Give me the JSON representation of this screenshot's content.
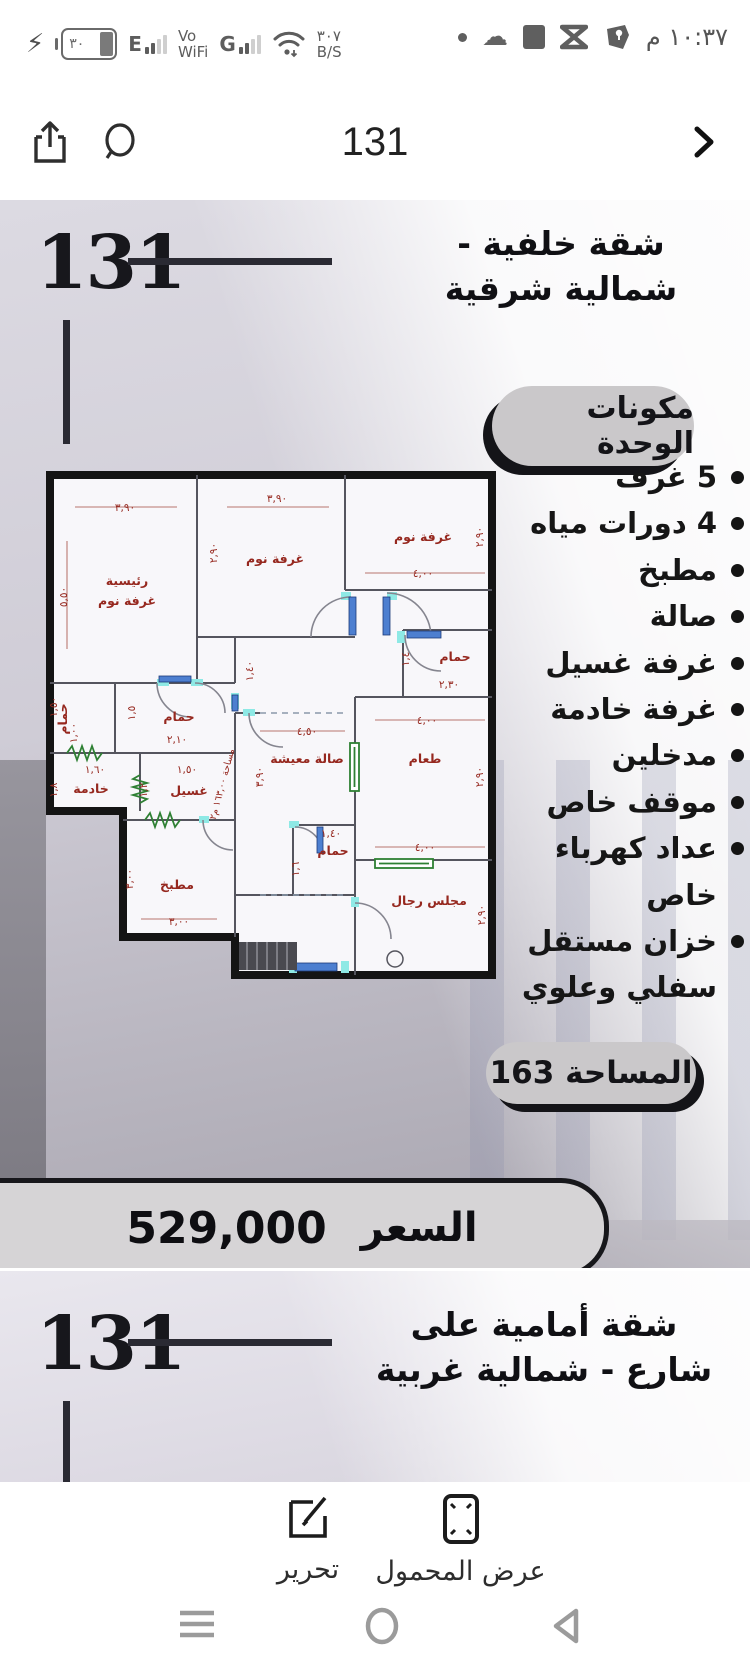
{
  "status_bar": {
    "time": "١٠:٣٧ م",
    "battery_level": "٣٠",
    "net1_letter": "E",
    "vowifi_top": "Vo",
    "vowifi_bottom": "WiFi",
    "net2_letter": "G",
    "speed_top": "٣٠٧",
    "speed_bottom": "B/S"
  },
  "nav_bar": {
    "title": "131"
  },
  "poster1": {
    "logo": "131",
    "title": "شقة خلفية - شمالية شرقية",
    "components_badge": "مكونات الوحدة",
    "features": [
      "5 غرف",
      "4 دورات مياه",
      "مطبخ",
      "صالة",
      "غرفة غسيل",
      "غرفة خادمة",
      "مدخلين",
      "موقف خاص",
      "عداد كهرباء خاص",
      "خزان مستقل سفلي وعلوي"
    ],
    "area_badge": "المساحة 163",
    "price_label": "السعر",
    "price_value": "529,000",
    "colors": {
      "accent_dark": "#141418",
      "pill_gray": "#cac8ca",
      "plan_red": "#96281f",
      "door_teal": "#8ee9e5",
      "door_blue": "#4d7fd0",
      "green": "#2e8033"
    }
  },
  "floor_plan": {
    "texts": [
      {
        "t": "رئيسية",
        "x": 82,
        "y": 140,
        "k": "room"
      },
      {
        "t": "غرفة نوم",
        "x": 82,
        "y": 160,
        "k": "room"
      },
      {
        "t": "غرفة نوم",
        "x": 230,
        "y": 118,
        "k": "room"
      },
      {
        "t": "غرفة نوم",
        "x": 378,
        "y": 96,
        "k": "room"
      },
      {
        "t": "حمام",
        "x": 410,
        "y": 216,
        "k": "room"
      },
      {
        "t": "حمام",
        "x": 134,
        "y": 276,
        "k": "room"
      },
      {
        "t": "حمام",
        "x": 22,
        "y": 274,
        "k": "room",
        "r": -90
      },
      {
        "t": "خادمة",
        "x": 46,
        "y": 348,
        "k": "room"
      },
      {
        "t": "غسيل",
        "x": 144,
        "y": 350,
        "k": "room"
      },
      {
        "t": "صالة معيشة",
        "x": 262,
        "y": 318,
        "k": "room"
      },
      {
        "t": "طعام",
        "x": 380,
        "y": 318,
        "k": "room"
      },
      {
        "t": "حمام",
        "x": 288,
        "y": 410,
        "k": "room"
      },
      {
        "t": "مطبخ",
        "x": 132,
        "y": 444,
        "k": "room"
      },
      {
        "t": "مجلس رجال",
        "x": 384,
        "y": 460,
        "k": "room"
      },
      {
        "t": "٣,٩٠",
        "x": 80,
        "y": 66,
        "k": "dim"
      },
      {
        "t": "٥,٥٠",
        "x": 22,
        "y": 152,
        "k": "dim",
        "r": -90
      },
      {
        "t": "٣,٩٠",
        "x": 232,
        "y": 57,
        "k": "dim"
      },
      {
        "t": "٢,٩٠",
        "x": 172,
        "y": 108,
        "k": "dim",
        "r": -90
      },
      {
        "t": "٤,٠٠",
        "x": 378,
        "y": 132,
        "k": "dim"
      },
      {
        "t": "٢,٩٠",
        "x": 438,
        "y": 92,
        "k": "dim",
        "r": -90
      },
      {
        "t": "١,٤٠",
        "x": 208,
        "y": 226,
        "k": "dim",
        "r": -90
      },
      {
        "t": "٢,٣٠",
        "x": 404,
        "y": 243,
        "k": "dim"
      },
      {
        "t": "١,٤",
        "x": 364,
        "y": 214,
        "k": "dim",
        "r": -90
      },
      {
        "t": "٢,١٠",
        "x": 132,
        "y": 298,
        "k": "dim"
      },
      {
        "t": "١,٥",
        "x": 90,
        "y": 268,
        "k": "dim",
        "r": -90
      },
      {
        "t": "١,٥٠",
        "x": 12,
        "y": 262,
        "k": "dim",
        "r": -90
      },
      {
        "t": "١,٠٠",
        "x": 32,
        "y": 288,
        "k": "dim",
        "r": -90
      },
      {
        "t": "١,٦٠",
        "x": 50,
        "y": 328,
        "k": "dim"
      },
      {
        "t": "١,٨",
        "x": 12,
        "y": 345,
        "k": "dim",
        "r": -90
      },
      {
        "t": "١,٥٠",
        "x": 142,
        "y": 328,
        "k": "dim"
      },
      {
        "t": "١,٢",
        "x": 102,
        "y": 345,
        "k": "dim",
        "r": -90
      },
      {
        "t": "٤,٥٠",
        "x": 262,
        "y": 290,
        "k": "dim"
      },
      {
        "t": "٣,٩٠",
        "x": 218,
        "y": 332,
        "k": "dim",
        "r": -90
      },
      {
        "t": "٤,٠٠",
        "x": 382,
        "y": 279,
        "k": "dim"
      },
      {
        "t": "٢,٩٠",
        "x": 438,
        "y": 332,
        "k": "dim",
        "r": -90
      },
      {
        "t": "١,٤٠",
        "x": 286,
        "y": 392,
        "k": "dim"
      },
      {
        "t": "١,٦",
        "x": 254,
        "y": 424,
        "k": "dim",
        "r": -90
      },
      {
        "t": "٣,٠٠",
        "x": 134,
        "y": 480,
        "k": "dim"
      },
      {
        "t": "٣,٠٠",
        "x": 88,
        "y": 434,
        "k": "dim",
        "r": -90
      },
      {
        "t": "٤,٠٠",
        "x": 380,
        "y": 406,
        "k": "dim"
      },
      {
        "t": "٢,٩٠",
        "x": 440,
        "y": 470,
        "k": "dim",
        "r": -90
      },
      {
        "t": "مساحة ١٦٣,٠٠ م٢",
        "x": 180,
        "y": 340,
        "k": "area",
        "r": -75
      }
    ]
  },
  "poster2": {
    "logo": "131",
    "title": "شقة أمامية على شارع - شمالية غربية"
  },
  "toolbar": {
    "edit_label": "تحرير",
    "mobile_view_label": "عرض المحمول"
  }
}
